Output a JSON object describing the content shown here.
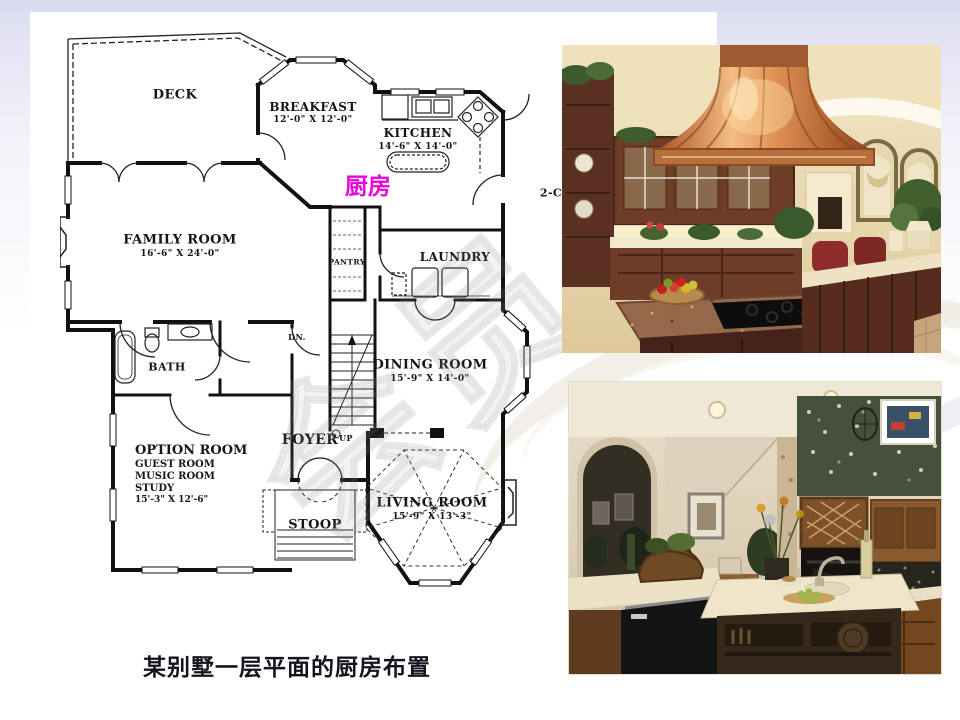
{
  "slide": {
    "caption": "某别墅一层平面的厨房布置",
    "background_top": "#d7d7ef",
    "background_bottom": "#ffffff"
  },
  "floor_plan": {
    "highlight": {
      "text": "厨房",
      "color": "#ea00d8"
    },
    "watermark": "会员",
    "garage_partial_label": "2-C",
    "stairs": {
      "down": "DN.",
      "up": "UP"
    },
    "rooms": [
      {
        "name": "DECK",
        "dims": ""
      },
      {
        "name": "BREAKFAST",
        "dims": "12'-0\" X 12'-0\""
      },
      {
        "name": "KITCHEN",
        "dims": "14'-6\" X 14'-0\""
      },
      {
        "name": "FAMILY ROOM",
        "dims": "16'-6\" X 24'-0\""
      },
      {
        "name": "PANTRY",
        "dims": ""
      },
      {
        "name": "LAUNDRY",
        "dims": ""
      },
      {
        "name": "BATH",
        "dims": ""
      },
      {
        "name": "DINING ROOM",
        "dims": "15'-9\" X 14'-0\""
      },
      {
        "name": "OPTION ROOM",
        "dims": "15'-3\" X 12'-6\"",
        "sub": [
          "GUEST ROOM",
          "MUSIC ROOM",
          "STUDY"
        ]
      },
      {
        "name": "FOYER",
        "dims": ""
      },
      {
        "name": "STOOP",
        "dims": ""
      },
      {
        "name": "LIVING ROOM",
        "dims": "15'-9\" X 13'-3\""
      }
    ]
  },
  "photos": [
    {
      "id": "kitchen-photo-1",
      "alt": "kitchen with copper island range hood"
    },
    {
      "id": "kitchen-photo-2",
      "alt": "kitchen with island sink and wood cabinets"
    }
  ]
}
